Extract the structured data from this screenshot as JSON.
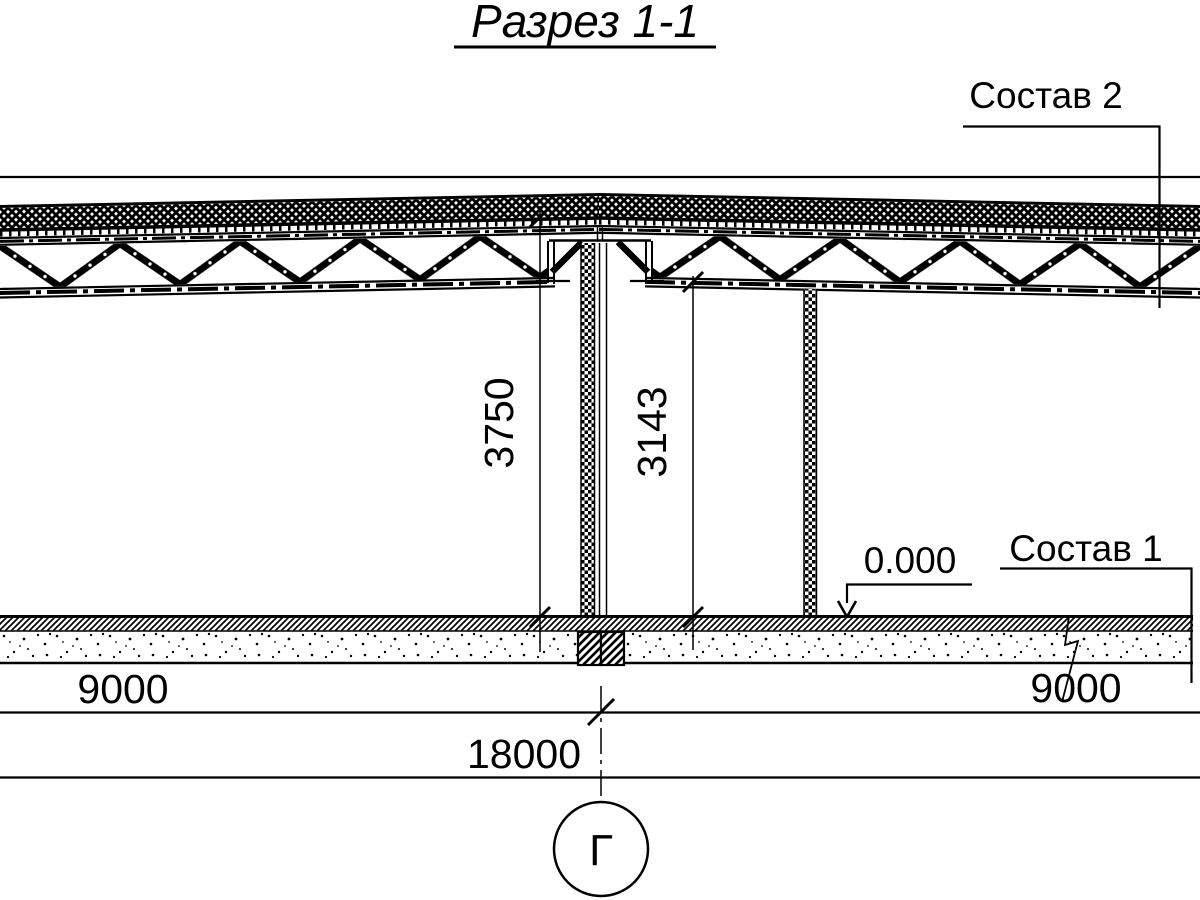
{
  "title": "Разрез 1-1",
  "labels": {
    "composition2": "Состав 2",
    "composition1": "Состав 1",
    "elevation": "0.000"
  },
  "dimensions": {
    "height_total": "3750",
    "height_clear": "3143",
    "span_left": "9000",
    "span_right": "9000",
    "span_total": "18000"
  },
  "axis": {
    "label": "Г"
  },
  "colors": {
    "ink": "#000000",
    "paper": "#ffffff"
  }
}
